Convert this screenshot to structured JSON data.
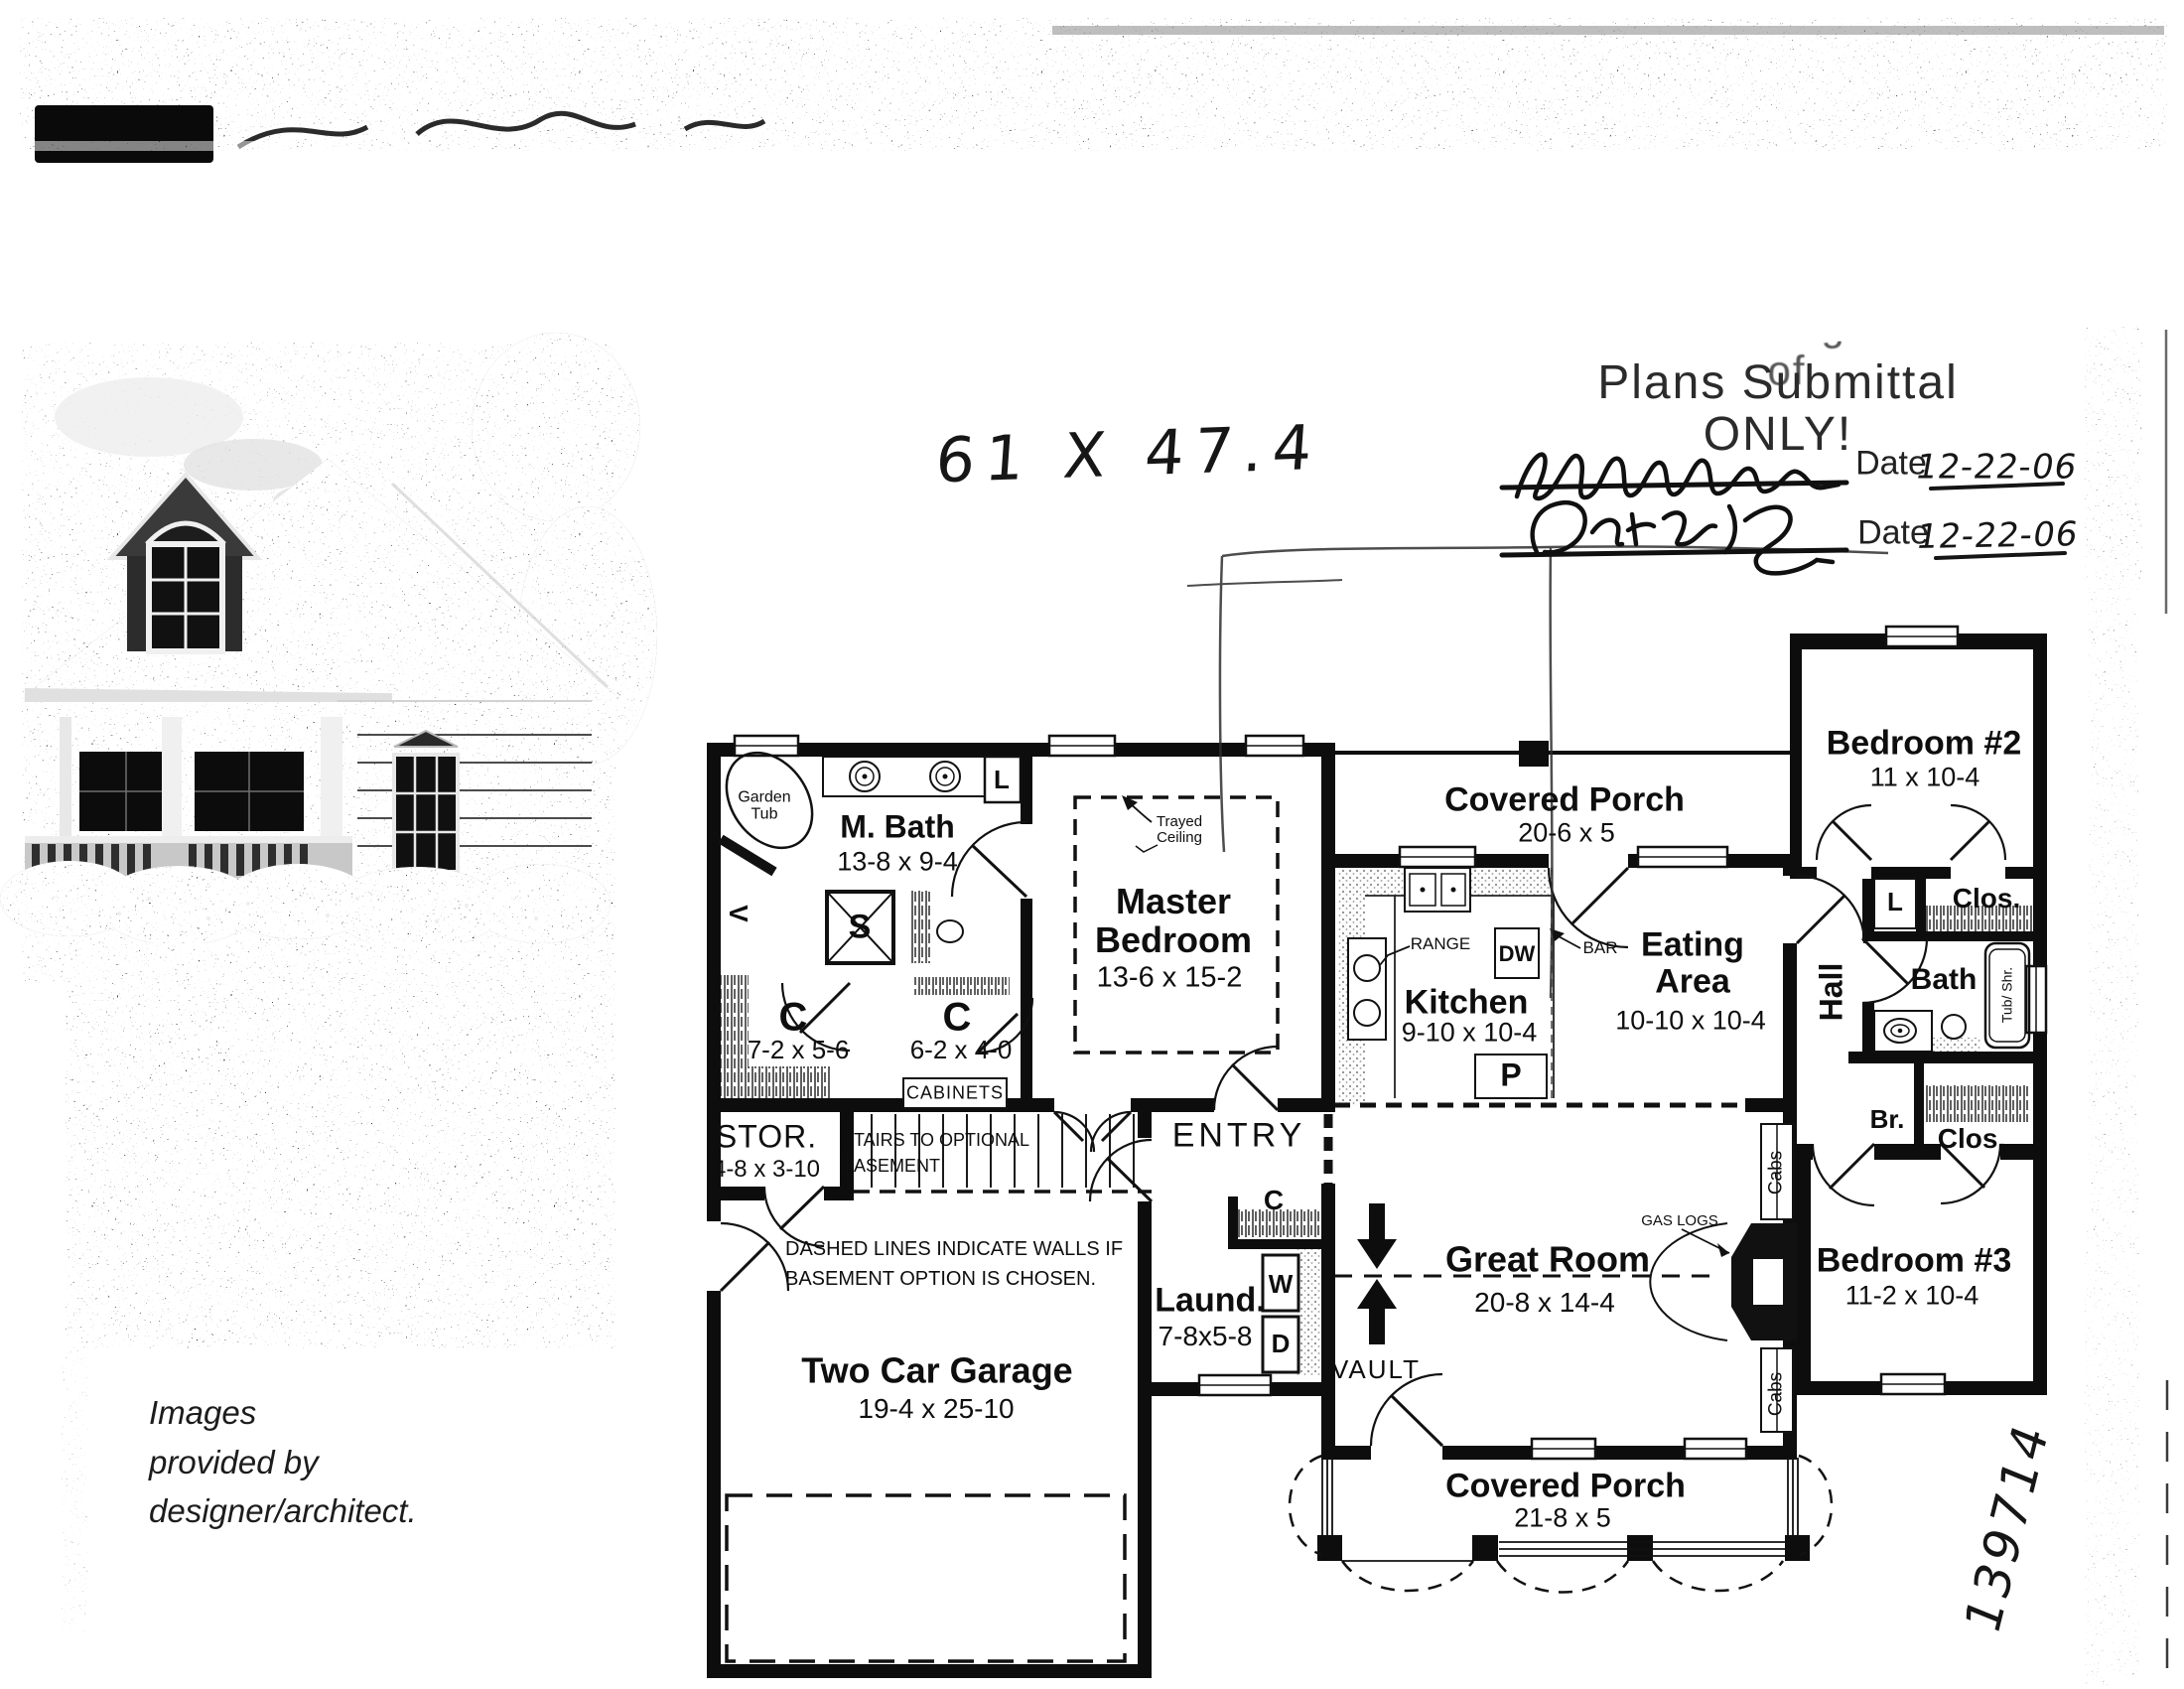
{
  "stamp": {
    "header_partial": "Acknowledgement of",
    "title": "Plans Submittal ONLY!",
    "date_label": "Date",
    "date1": "12-22-06",
    "date2": "12-22-06"
  },
  "handwritten": {
    "size_note": "61 X 47.4",
    "plan_number": "139714"
  },
  "credit": "Images\nprovided by\ndesigner/architect.",
  "plan": {
    "m_bath": {
      "name": "M. Bath",
      "dims": "13-8 x 9-4"
    },
    "garden_tub": "Garden\nTub",
    "vanity": "V",
    "linen_mbath": "L",
    "shower": "S",
    "closet1": {
      "name": "C",
      "dims": "7-2 x 5-6"
    },
    "closet2": {
      "name": "C",
      "dims": "6-2 x 4-0"
    },
    "cabinets": "CABINETS",
    "master": {
      "name": "Master\nBedroom",
      "dims": "13-6 x 15-2",
      "ceiling_note": "Trayed\nCeiling"
    },
    "porch_rear": {
      "name": "Covered Porch",
      "dims": "20-6 x 5"
    },
    "kitchen": {
      "name": "Kitchen",
      "dims": "9-10 x 10-4",
      "range": "RANGE",
      "dishwasher": "DW",
      "bar": "BAR",
      "pantry": "P"
    },
    "eating": {
      "name": "Eating\nArea",
      "dims": "10-10 x 10-4"
    },
    "hall": "Hall",
    "bedroom2": {
      "name": "Bedroom #2",
      "dims": "11 x 10-4"
    },
    "linen_hall": "L",
    "closet_bed2": "Clos.",
    "bath2": {
      "name": "Bath",
      "tub": "Tub/ Shr."
    },
    "broom_closet": "Br.",
    "closet_bed3": "Clos.",
    "bedroom3": {
      "name": "Bedroom #3",
      "dims": "11-2 x 10-4"
    },
    "great_room": {
      "name": "Great Room",
      "dims": "20-8 x 14-4",
      "vault": "VAULT",
      "gas_logs": "GAS LOGS",
      "cabs": "Cabs"
    },
    "entry": {
      "name": "ENTRY",
      "closet": "C"
    },
    "laundry": {
      "name": "Laund.",
      "dims": "7-8x5-8",
      "washer": "W",
      "dryer": "D"
    },
    "storage": {
      "name": "STOR.",
      "dims": "4-8 x 3-10"
    },
    "stairs_note": "STAIRS TO OPTIONAL\nBASEMENT",
    "basement_note": "DASHED LINES INDICATE WALLS IF\nBASEMENT OPTION IS CHOSEN.",
    "garage": {
      "name": "Two Car Garage",
      "dims": "19-4 x 25-10"
    },
    "porch_front": {
      "name": "Covered Porch",
      "dims": "21-8 x 5"
    }
  }
}
